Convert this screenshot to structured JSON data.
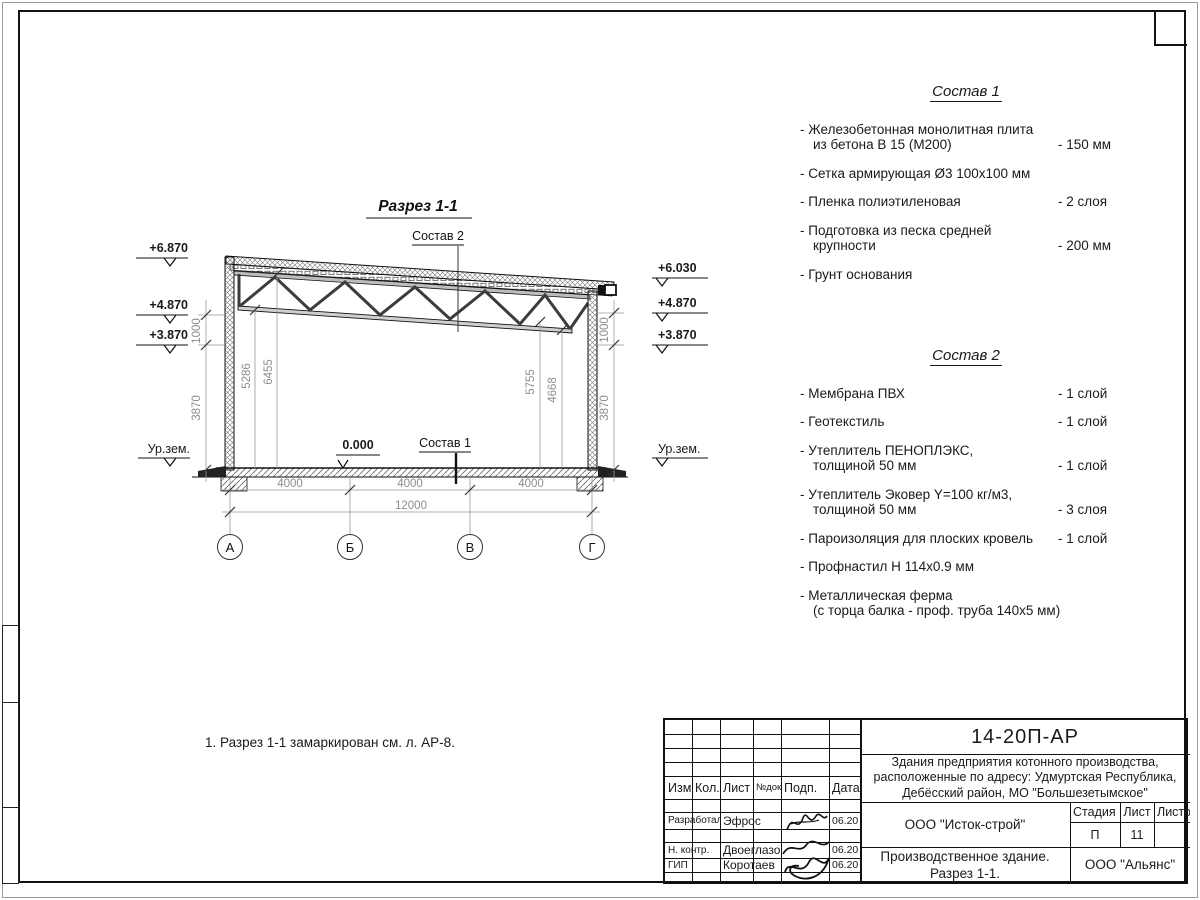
{
  "drawing": {
    "title": "Разрез 1-1",
    "note": "1. Разрез 1-1 замаркирован см. л. АР-8.",
    "sostav2_label": "Состав 2",
    "sostav1_label": "Состав 1",
    "zero_mark": "0.000",
    "ground_left": "Ур.зем.",
    "ground_right": "Ур.зем.",
    "elev_left": [
      "+6.870",
      "+4.870",
      "+3.870"
    ],
    "elev_right": [
      "+6.030",
      "+4.870",
      "+3.870"
    ],
    "dim_left": [
      "1000",
      "3870"
    ],
    "dim_right": [
      "1000",
      "3870"
    ],
    "dim_interior": [
      "5286",
      "6455",
      "5755",
      "4668"
    ],
    "dim_spans": [
      "4000",
      "4000",
      "4000"
    ],
    "dim_total": "12000",
    "axes": [
      "А",
      "Б",
      "В",
      "Г"
    ]
  },
  "sostav1": {
    "title": "Состав 1",
    "items": [
      {
        "text": "- Железобетонная  монолитная плита\nиз бетона В 15 (М200)",
        "value": "- 150 мм"
      },
      {
        "text": "- Сетка армирующая Ø3 100х100 мм",
        "value": ""
      },
      {
        "text": "- Пленка полиэтиленовая",
        "value": "-  2 слоя"
      },
      {
        "text": "- Подготовка из песка средней\nкрупности",
        "value": "- 200 мм"
      },
      {
        "text": "- Грунт основания",
        "value": ""
      }
    ]
  },
  "sostav2": {
    "title": "Состав 2",
    "items": [
      {
        "text": "- Мембрана ПВХ",
        "value": "- 1 слой"
      },
      {
        "text": "- Геотекстиль",
        "value": "- 1 слой"
      },
      {
        "text": "- Утеплитель ПЕНОПЛЭКС,\nтолщиной 50 мм",
        "value": "- 1 слой"
      },
      {
        "text": "- Утеплитель Эковер Y=100 кг/м3,\nтолщиной 50 мм",
        "value": "- 3 слоя"
      },
      {
        "text": "- Пароизоляция для плоских кровель",
        "value": "- 1 слой"
      },
      {
        "text": "- Профнастил Н 114х0.9 мм",
        "value": ""
      },
      {
        "text": "- Металлическая ферма\n(с торца балка - проф. труба 140х5 мм)",
        "value": ""
      }
    ]
  },
  "titleblock": {
    "doc_number": "14-20П-АР",
    "project": "Здания предприятия котонного производства,\nрасположенные по адресу: Удмуртская Республика,\nДебёсский район, МО \"Большезетымское\"",
    "headers": {
      "izm": "Изм.",
      "kol": "Кол.",
      "list": "Лист",
      "ndok": "№док.",
      "podp": "Подп.",
      "data": "Дата"
    },
    "rows": [
      {
        "role": "Разработал",
        "name": "Эфрос",
        "date": "06.20"
      },
      {
        "role": "Н. контр.",
        "name": "Двоеглазов",
        "date": "06.20"
      },
      {
        "role": "ГИП",
        "name": "Коротаев",
        "date": "06.20"
      }
    ],
    "org1": "ООО \"Исток-строй\"",
    "stage_headers": {
      "stage": "Стадия",
      "sheet": "Лист",
      "sheets": "Листов"
    },
    "stage_values": {
      "stage": "П",
      "sheet": "11",
      "sheets": ""
    },
    "subtitle": "Производственное здание.\nРазрез 1-1.",
    "org2": "ООО \"Альянс\""
  }
}
